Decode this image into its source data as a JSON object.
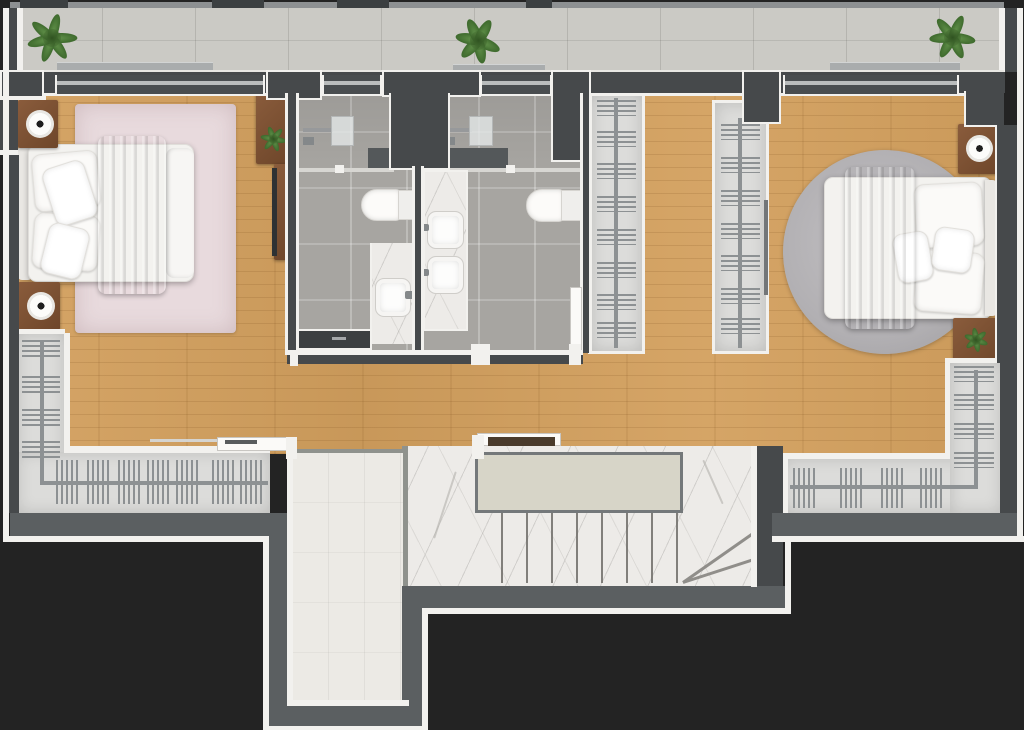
{
  "scene": {
    "type": "3D rendered floor plan",
    "view": "top-down",
    "description": "Upper-floor apartment plan with two bedrooms, two bathrooms, walk-in closet, wardrobes, stair hall and balcony"
  },
  "palette": {
    "bg": "#232323",
    "outline": "#f2f1ee",
    "wall_dark": "#46494b",
    "wall_deep": "#3b3f41",
    "wall_mid": "#5b5f61",
    "wood": "#d3a05e",
    "balcony_tile": "#cbcac5",
    "bath_tile": "#a7a5a1",
    "marble": "#edebe8",
    "marble_vein": "#b3b0ac",
    "corridor_tile": "#eceae5",
    "closet_floor": "#dcdcda",
    "rack": "#8d9193",
    "rug_pink": "#e8dadd",
    "rug_gray": "#b4b2b5",
    "bed_white": "#f3f2ef",
    "blanket_gray": "#9da2a7",
    "furniture_wood": "#7b5336",
    "plant_green": "#4c7a38",
    "fixture_white": "#fbfaf8",
    "door_dark": "#3c3f41",
    "sill": "#a9acad"
  },
  "rooms": {
    "balcony": {
      "name": "Balcony",
      "features": [
        "tiled floor",
        "railing",
        "3 potted ferns",
        "window sills"
      ]
    },
    "bedroom_left": {
      "name": "Left bedroom",
      "furniture": [
        "double bed with gray blanket",
        "two nightstands with decor bowls",
        "pink area rug",
        "dresser with plant",
        "TV console"
      ]
    },
    "bathroom_left": {
      "name": "Bathroom 1",
      "fixtures": [
        "rain shower",
        "toilet",
        "marble counter with basin",
        "dark sliding door"
      ]
    },
    "bathroom_right": {
      "name": "Bathroom 2",
      "fixtures": [
        "rain shower",
        "toilet",
        "double-basin marble vanity",
        "door"
      ]
    },
    "closet": {
      "name": "Walk-in closet",
      "features": [
        "two hanging rails full of hangers"
      ]
    },
    "bedroom_right": {
      "name": "Right bedroom",
      "furniture": [
        "double bed with gray blanket",
        "round gray rug",
        "two nightstands",
        "potted plant"
      ]
    },
    "hallway": {
      "name": "Hallway",
      "features": [
        "wood flooring",
        "two door openings to stair hall"
      ]
    },
    "wardrobe_left": {
      "name": "Left wardrobe",
      "features": [
        "L-shaped hanging rail with hangers"
      ]
    },
    "wardrobe_right": {
      "name": "Right wardrobe",
      "features": [
        "L-shaped hanging rail with hangers"
      ]
    },
    "stairwell": {
      "name": "Stair hall",
      "features": [
        "tiled corridor",
        "marble floor",
        "upper landing",
        "straight flight with winders"
      ]
    }
  }
}
